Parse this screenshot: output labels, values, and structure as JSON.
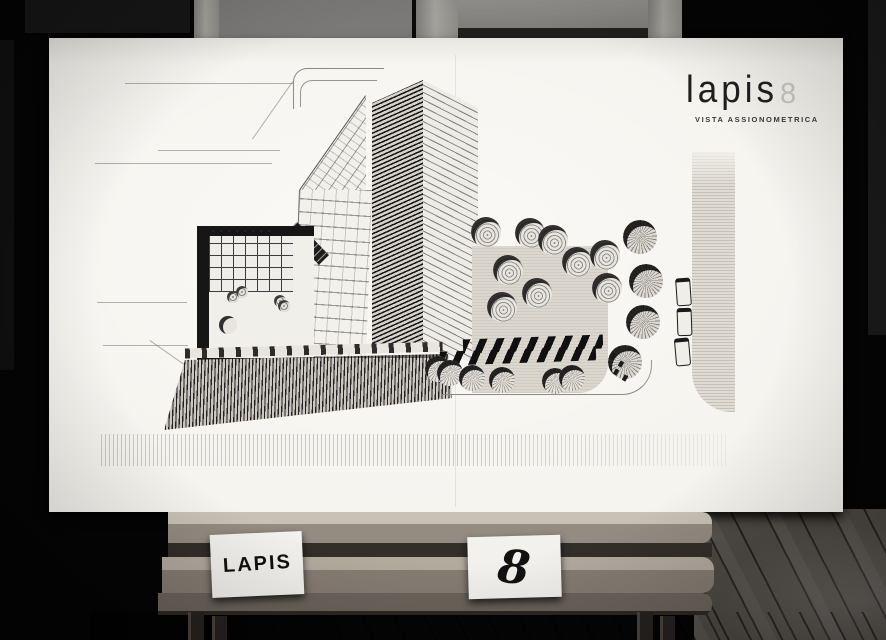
{
  "board": {
    "logo": {
      "brand": "lapis",
      "number": "8",
      "subtitle": "VISTA ASSIONOMETRICA"
    }
  },
  "easel": {
    "cards": [
      {
        "label": "LAPIS"
      },
      {
        "label": "8"
      }
    ]
  },
  "colors": {
    "background": "#040404",
    "board_paper": "#f6f4ef",
    "drawing_ink": "#1c1c1c",
    "logo_ink": "#1f1f1f",
    "logo_number_faint": "#cac8c3",
    "wood_light": "#c9c1b5",
    "wood_mid": "#948b81",
    "wood_dark": "#2c2823",
    "floor": "#4e4a44"
  }
}
